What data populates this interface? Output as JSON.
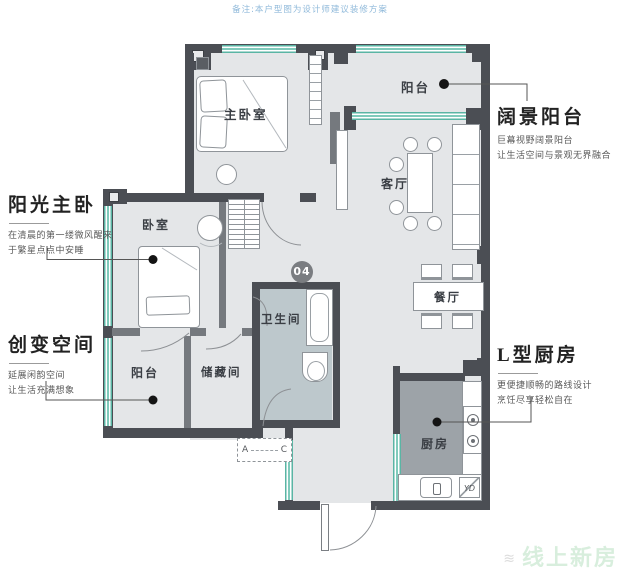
{
  "note": "备注:本户型图为设计师建议装修方案",
  "unit_badge": "04",
  "annotations": {
    "sunny_master": {
      "title": "阳光主卧",
      "line1": "在清晨的第一缕微风醒来",
      "line2": "于繁星点点中安睡"
    },
    "creative_space": {
      "title": "创变空间",
      "line1": "延展闲韵空间",
      "line2": "让生活充满想象"
    },
    "wide_balcony": {
      "title": "阔景阳台",
      "line1": "巨幕视野阔景阳台",
      "line2": "让生活空间与景观无界融合"
    },
    "l_kitchen": {
      "title": "L型厨房",
      "line1": "更便捷顺畅的路线设计",
      "line2": "烹饪尽享轻松自在"
    }
  },
  "rooms": {
    "master_bedroom": "主卧室",
    "balcony_top": "阳台",
    "living_room": "客厅",
    "dining_room": "餐厅",
    "bedroom": "卧室",
    "bathroom": "卫生间",
    "balcony_bottom": "阳台",
    "storage": "储藏间",
    "kitchen": "厨房"
  },
  "markers": {
    "ac_left": "A",
    "ac_right": "C",
    "washer": "YD"
  },
  "watermark": {
    "text": "线上新房"
  },
  "colors": {
    "wall": "#4b4e54",
    "window_teal": "#5ab5a4",
    "floor": "#e4e6e8",
    "kitchen_floor": "#9da3a8",
    "bath_floor": "#bdc8cc",
    "note_blue": "#8fb9da",
    "watermark_green": "#d8eedd"
  }
}
